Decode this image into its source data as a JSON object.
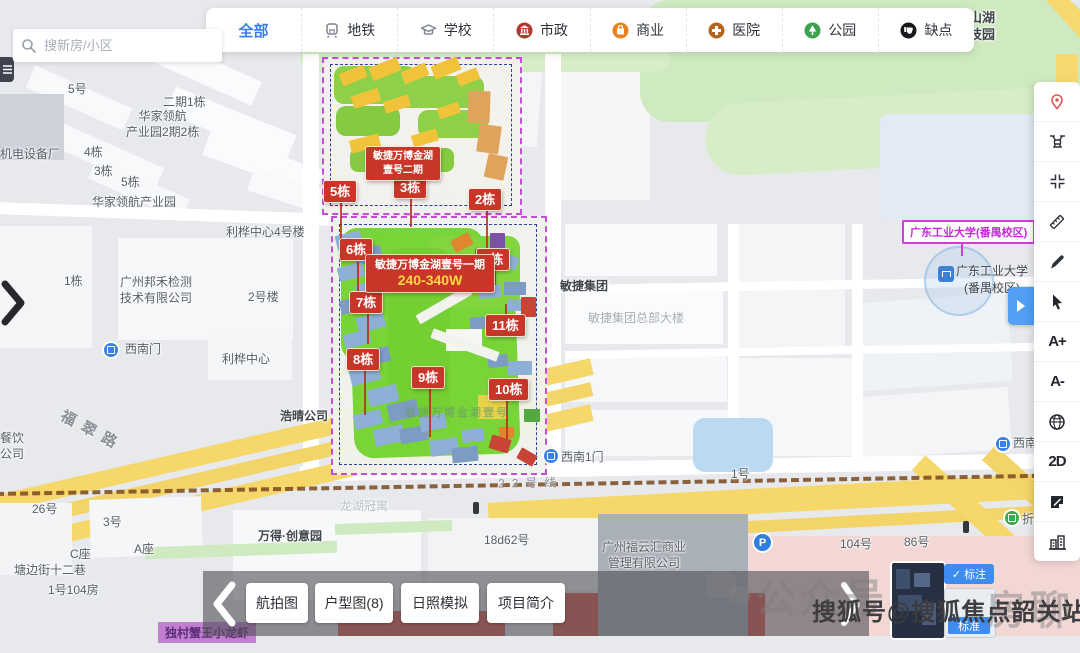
{
  "search": {
    "placeholder": "搜新房/小区"
  },
  "filter_bar": {
    "items": [
      {
        "label": "全部",
        "active": true
      },
      {
        "label": "地铁"
      },
      {
        "label": "学校"
      },
      {
        "label": "市政"
      },
      {
        "label": "商业"
      },
      {
        "label": "医院"
      },
      {
        "label": "公园"
      },
      {
        "label": "缺点"
      }
    ]
  },
  "side_tools": {
    "items": [
      {
        "name": "location-pin"
      },
      {
        "name": "drone-view"
      },
      {
        "name": "fullscreen"
      },
      {
        "name": "measure"
      },
      {
        "name": "draw"
      },
      {
        "name": "select-cursor"
      },
      {
        "name": "font-increase",
        "label": "A+"
      },
      {
        "name": "font-decrease",
        "label": "A-"
      },
      {
        "name": "earth-view"
      },
      {
        "name": "view-2d",
        "label": "2D"
      },
      {
        "name": "annotation-notes"
      },
      {
        "name": "buildings-3d"
      }
    ]
  },
  "bottom_bar": {
    "buttons": [
      "航拍图",
      "户型图(8)",
      "日照模拟",
      "项目简介"
    ]
  },
  "layer_switcher": {
    "check": "✓",
    "annotation": "标注",
    "standard": "标准"
  },
  "site": {
    "phase2_label": "敏捷万博金湖壹号二期",
    "phase1_label": "敏捷万博金湖壹号一期",
    "phase1_price": "240-340W",
    "plan_watermark": "敏捷万博金湖壹号",
    "tags": [
      "5栋",
      "3栋",
      "2栋",
      "6栋",
      "1栋",
      "7栋",
      "11栋",
      "8栋",
      "9栋",
      "10栋"
    ],
    "accent_red": "#c8362a",
    "boundary_purple": "#c44fd4"
  },
  "map": {
    "poi_labels": [
      "龙沁金山湖\n文化科技园",
      "5号",
      "二期1栋",
      "华家领航\n产业园2期2栋",
      "机电设备厂",
      "4栋",
      "3栋",
      "5栋",
      "华家领航产业园",
      "1栋",
      "广州邦禾检测\n技术有限公司",
      "2号楼",
      "利桦中心4号楼",
      "利桦中心",
      "浩晴公司",
      "敏捷集团",
      "敏捷集团总部大楼",
      "西南门",
      "西南1门",
      "西南",
      "餐饮\n公司",
      "26号",
      "龙湖冠寓",
      "3号",
      "C座",
      "A座",
      "塘边街十二巷",
      "1号104房",
      "万得·创意园",
      "18d62号",
      "广州福云汇商业\n管理有限公司",
      "104号",
      "86号",
      "1号",
      "折福"
    ],
    "university_label": "广东工业大学(番禺校区)",
    "university_poi": "广东工业大学\n(番禺校区)",
    "metro_line": "22号线",
    "road_fucui": "福翠路",
    "parking": "P",
    "partial_poi": "独村蟹王小龙虾",
    "uni_magenta": "#d23bdc"
  },
  "watermarks": {
    "primary": "搜狐号@搜狐焦点韶关站",
    "bg_left": "公众号",
    "bg_right": "房聊"
  }
}
